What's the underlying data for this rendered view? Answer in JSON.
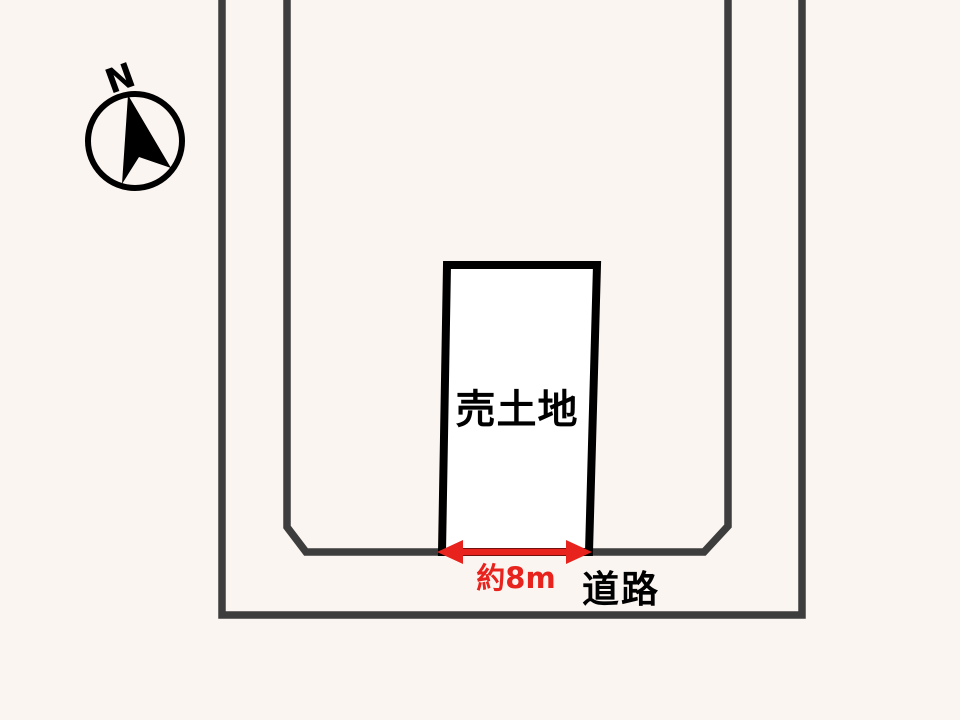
{
  "diagram": {
    "compass": {
      "north_label": "N"
    },
    "land_plot": {
      "label": "売土地"
    },
    "frontage": {
      "label": "約8m"
    },
    "road": {
      "label": "道路"
    }
  },
  "colors": {
    "background": "#FBF5F1",
    "road_line": "#3D3D3D",
    "plot_border": "#000000",
    "plot_fill": "#FFFFFF",
    "accent_red": "#E8221D",
    "label_text": "#000000"
  }
}
